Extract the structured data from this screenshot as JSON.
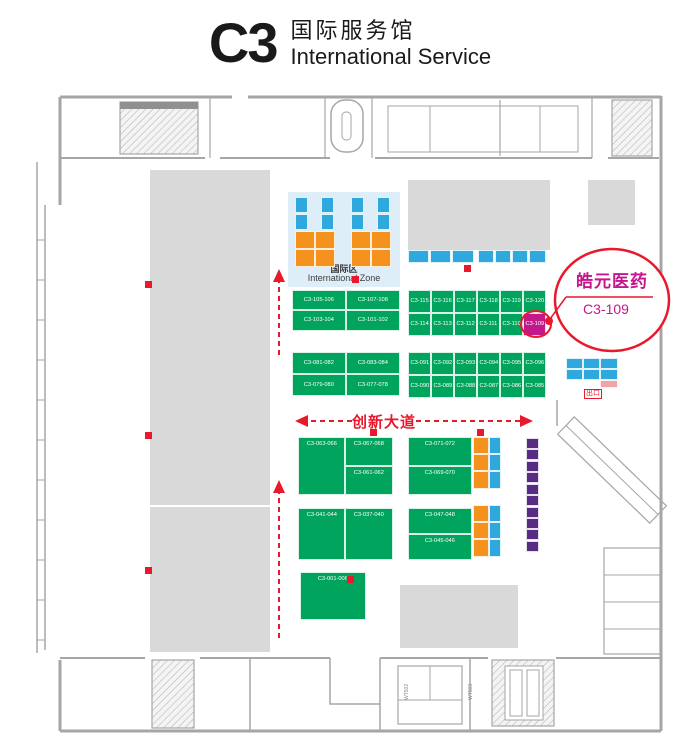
{
  "header": {
    "hall_code": "C3",
    "title_cn": "国际服务馆",
    "title_en": "International  Service"
  },
  "colors": {
    "green": "#00a45c",
    "blue": "#2fa8dd",
    "orange": "#f5921e",
    "purple": "#582c83",
    "magenta": "#c3188c",
    "pink": "#f0a3a8",
    "red": "#e8192c"
  },
  "international_zone": {
    "label_cn": "国际区",
    "label_en": "International Zone"
  },
  "road": {
    "label": "创新大道"
  },
  "callout": {
    "company": "皓元医药",
    "booth": "C3-109"
  },
  "exit": {
    "label": "出口"
  },
  "highlight_booth": "C3-109",
  "bottom_labels": [
    {
      "text": "WT502",
      "x": 404,
      "y": 700
    },
    {
      "text": "WT503",
      "x": 468,
      "y": 700
    }
  ],
  "markers": [
    {
      "x": 145,
      "y": 281
    },
    {
      "x": 145,
      "y": 432
    },
    {
      "x": 145,
      "y": 567
    },
    {
      "x": 464,
      "y": 265
    },
    {
      "x": 370,
      "y": 429
    },
    {
      "x": 477,
      "y": 429
    },
    {
      "x": 347,
      "y": 576
    }
  ],
  "blocks": [
    {
      "id": "intl-group-1",
      "x": 295,
      "y": 197,
      "color": "blue",
      "cells": [
        {
          "x": 0,
          "y": 0,
          "w": 13,
          "h": 16,
          "label": ""
        },
        {
          "x": 0,
          "y": 17,
          "w": 13,
          "h": 16,
          "label": ""
        },
        {
          "x": 26,
          "y": 0,
          "w": 13,
          "h": 16,
          "label": ""
        },
        {
          "x": 26,
          "y": 17,
          "w": 13,
          "h": 16,
          "label": ""
        },
        {
          "x": 0,
          "y": 34,
          "w": 20,
          "h": 18,
          "label": "",
          "color": "orange"
        },
        {
          "x": 20,
          "y": 34,
          "w": 20,
          "h": 18,
          "label": "",
          "color": "orange"
        },
        {
          "x": 0,
          "y": 52,
          "w": 20,
          "h": 18,
          "label": "",
          "color": "orange"
        },
        {
          "x": 20,
          "y": 52,
          "w": 20,
          "h": 18,
          "label": "",
          "color": "orange"
        }
      ]
    },
    {
      "id": "intl-group-2",
      "x": 351,
      "y": 197,
      "color": "blue",
      "cells": [
        {
          "x": 0,
          "y": 0,
          "w": 13,
          "h": 16,
          "label": ""
        },
        {
          "x": 0,
          "y": 17,
          "w": 13,
          "h": 16,
          "label": ""
        },
        {
          "x": 26,
          "y": 0,
          "w": 13,
          "h": 16,
          "label": ""
        },
        {
          "x": 26,
          "y": 17,
          "w": 13,
          "h": 16,
          "label": ""
        },
        {
          "x": 0,
          "y": 34,
          "w": 20,
          "h": 18,
          "label": "",
          "color": "orange"
        },
        {
          "x": 20,
          "y": 34,
          "w": 20,
          "h": 18,
          "label": "",
          "color": "orange"
        },
        {
          "x": 0,
          "y": 52,
          "w": 20,
          "h": 18,
          "label": "",
          "color": "orange"
        },
        {
          "x": 20,
          "y": 52,
          "w": 20,
          "h": 18,
          "label": "",
          "color": "orange"
        }
      ]
    },
    {
      "id": "service-row-left",
      "x": 408,
      "y": 250,
      "color": "blue",
      "cells": [
        {
          "x": 0,
          "y": 0,
          "w": 21,
          "h": 13,
          "label": ""
        },
        {
          "x": 22,
          "y": 0,
          "w": 21,
          "h": 13,
          "label": ""
        },
        {
          "x": 44,
          "y": 0,
          "w": 22,
          "h": 13,
          "label": ""
        }
      ]
    },
    {
      "id": "service-row-right",
      "x": 478,
      "y": 250,
      "color": "blue",
      "cells": [
        {
          "x": 0,
          "y": 0,
          "w": 16,
          "h": 13,
          "label": ""
        },
        {
          "x": 17,
          "y": 0,
          "w": 16,
          "h": 13,
          "label": ""
        },
        {
          "x": 34,
          "y": 0,
          "w": 16,
          "h": 13,
          "label": ""
        },
        {
          "x": 51,
          "y": 0,
          "w": 17,
          "h": 13,
          "label": ""
        }
      ]
    },
    {
      "id": "block-101-108",
      "x": 292,
      "y": 290,
      "color": "green",
      "cells": [
        {
          "x": 0,
          "y": 0,
          "w": 54,
          "h": 20,
          "label": "C3-105-106"
        },
        {
          "x": 54,
          "y": 0,
          "w": 54,
          "h": 20,
          "label": "C3-107-108"
        },
        {
          "x": 0,
          "y": 20,
          "w": 54,
          "h": 21,
          "label": "C3-103-104"
        },
        {
          "x": 54,
          "y": 20,
          "w": 54,
          "h": 21,
          "label": "C3-101-102"
        }
      ]
    },
    {
      "id": "block-109-120",
      "x": 408,
      "y": 290,
      "color": "green",
      "cells": [
        {
          "x": 0,
          "y": 0,
          "w": 23,
          "h": 23,
          "label": "C3-115"
        },
        {
          "x": 23,
          "y": 0,
          "w": 23,
          "h": 23,
          "label": "C3-116"
        },
        {
          "x": 46,
          "y": 0,
          "w": 23,
          "h": 23,
          "label": "C3-117"
        },
        {
          "x": 69,
          "y": 0,
          "w": 23,
          "h": 23,
          "label": "C3-118"
        },
        {
          "x": 92,
          "y": 0,
          "w": 23,
          "h": 23,
          "label": "C3-119"
        },
        {
          "x": 115,
          "y": 0,
          "w": 23,
          "h": 23,
          "label": "C3-120"
        },
        {
          "x": 0,
          "y": 23,
          "w": 23,
          "h": 23,
          "label": "C3-114"
        },
        {
          "x": 23,
          "y": 23,
          "w": 23,
          "h": 23,
          "label": "C3-113"
        },
        {
          "x": 46,
          "y": 23,
          "w": 23,
          "h": 23,
          "label": "C3-112"
        },
        {
          "x": 69,
          "y": 23,
          "w": 23,
          "h": 23,
          "label": "C3-111"
        },
        {
          "x": 92,
          "y": 23,
          "w": 23,
          "h": 23,
          "label": "C3-110"
        },
        {
          "x": 115,
          "y": 23,
          "w": 23,
          "h": 23,
          "label": "C3-109",
          "color": "magenta"
        }
      ]
    },
    {
      "id": "block-077-084",
      "x": 292,
      "y": 352,
      "color": "green",
      "cells": [
        {
          "x": 0,
          "y": 0,
          "w": 54,
          "h": 22,
          "label": "C3-081-082"
        },
        {
          "x": 54,
          "y": 0,
          "w": 54,
          "h": 22,
          "label": "C3-083-084"
        },
        {
          "x": 0,
          "y": 22,
          "w": 54,
          "h": 22,
          "label": "C3-079-080"
        },
        {
          "x": 54,
          "y": 22,
          "w": 54,
          "h": 22,
          "label": "C3-077-078"
        }
      ]
    },
    {
      "id": "block-085-096",
      "x": 408,
      "y": 352,
      "color": "green",
      "cells": [
        {
          "x": 0,
          "y": 0,
          "w": 23,
          "h": 23,
          "label": "C3-091"
        },
        {
          "x": 23,
          "y": 0,
          "w": 23,
          "h": 23,
          "label": "C3-092"
        },
        {
          "x": 46,
          "y": 0,
          "w": 23,
          "h": 23,
          "label": "C3-093"
        },
        {
          "x": 69,
          "y": 0,
          "w": 23,
          "h": 23,
          "label": "C3-094"
        },
        {
          "x": 92,
          "y": 0,
          "w": 23,
          "h": 23,
          "label": "C3-095"
        },
        {
          "x": 115,
          "y": 0,
          "w": 23,
          "h": 23,
          "label": "C3-096"
        },
        {
          "x": 0,
          "y": 23,
          "w": 23,
          "h": 23,
          "label": "C3-090"
        },
        {
          "x": 23,
          "y": 23,
          "w": 23,
          "h": 23,
          "label": "C3-089"
        },
        {
          "x": 46,
          "y": 23,
          "w": 23,
          "h": 23,
          "label": "C3-088"
        },
        {
          "x": 69,
          "y": 23,
          "w": 23,
          "h": 23,
          "label": "C3-087"
        },
        {
          "x": 92,
          "y": 23,
          "w": 23,
          "h": 23,
          "label": "C3-086"
        },
        {
          "x": 115,
          "y": 23,
          "w": 23,
          "h": 23,
          "label": "C3-085"
        }
      ]
    },
    {
      "id": "block-061-068",
      "x": 298,
      "y": 437,
      "color": "green",
      "cells": [
        {
          "x": 0,
          "y": 0,
          "w": 47,
          "h": 58,
          "label": "C3-063-066"
        },
        {
          "x": 47,
          "y": 0,
          "w": 48,
          "h": 29,
          "label": "C3-067-068"
        },
        {
          "x": 47,
          "y": 29,
          "w": 48,
          "h": 29,
          "label": "C3-061-062"
        }
      ]
    },
    {
      "id": "block-069-072",
      "x": 408,
      "y": 437,
      "color": "green",
      "cells": [
        {
          "x": 0,
          "y": 0,
          "w": 64,
          "h": 29,
          "label": "C3-071-072"
        },
        {
          "x": 0,
          "y": 29,
          "w": 64,
          "h": 29,
          "label": "C3-069-070"
        }
      ]
    },
    {
      "id": "block-037-044",
      "x": 298,
      "y": 508,
      "color": "green",
      "cells": [
        {
          "x": 0,
          "y": 0,
          "w": 47,
          "h": 52,
          "label": "C3-041-044"
        },
        {
          "x": 47,
          "y": 0,
          "w": 48,
          "h": 52,
          "label": "C3-037-040"
        }
      ]
    },
    {
      "id": "block-045-048",
      "x": 408,
      "y": 508,
      "color": "green",
      "cells": [
        {
          "x": 0,
          "y": 0,
          "w": 64,
          "h": 26,
          "label": "C3-047-048"
        },
        {
          "x": 0,
          "y": 26,
          "w": 64,
          "h": 26,
          "label": "C3-045-046"
        }
      ]
    },
    {
      "id": "block-001-006",
      "x": 300,
      "y": 572,
      "color": "green",
      "cells": [
        {
          "x": 0,
          "y": 0,
          "w": 66,
          "h": 48,
          "label": "C3-001-006"
        }
      ]
    },
    {
      "id": "small-booths-upper",
      "x": 473,
      "y": 437,
      "color": "orange",
      "cells": [
        {
          "x": 0,
          "y": 0,
          "w": 16,
          "h": 17,
          "label": ""
        },
        {
          "x": 0,
          "y": 17,
          "w": 16,
          "h": 17,
          "label": ""
        },
        {
          "x": 0,
          "y": 34,
          "w": 16,
          "h": 18,
          "label": ""
        },
        {
          "x": 16,
          "y": 0,
          "w": 12,
          "h": 17,
          "label": "",
          "color": "blue"
        },
        {
          "x": 16,
          "y": 17,
          "w": 12,
          "h": 17,
          "label": "",
          "color": "blue"
        },
        {
          "x": 16,
          "y": 34,
          "w": 12,
          "h": 18,
          "label": "",
          "color": "blue"
        }
      ]
    },
    {
      "id": "small-booths-lower",
      "x": 473,
      "y": 505,
      "color": "orange",
      "cells": [
        {
          "x": 0,
          "y": 0,
          "w": 16,
          "h": 17,
          "label": ""
        },
        {
          "x": 0,
          "y": 17,
          "w": 16,
          "h": 17,
          "label": ""
        },
        {
          "x": 0,
          "y": 34,
          "w": 16,
          "h": 18,
          "label": ""
        },
        {
          "x": 16,
          "y": 0,
          "w": 12,
          "h": 17,
          "label": "",
          "color": "blue"
        },
        {
          "x": 16,
          "y": 17,
          "w": 12,
          "h": 17,
          "label": "",
          "color": "blue"
        },
        {
          "x": 16,
          "y": 34,
          "w": 12,
          "h": 18,
          "label": "",
          "color": "blue"
        }
      ]
    },
    {
      "id": "purple-strip",
      "x": 526,
      "y": 438,
      "color": "purple",
      "cells": [
        {
          "x": 0,
          "y": 0,
          "w": 13,
          "h": 11,
          "label": ""
        },
        {
          "x": 0,
          "y": 11,
          "w": 13,
          "h": 11,
          "label": ""
        },
        {
          "x": 0,
          "y": 23,
          "w": 13,
          "h": 11,
          "label": ""
        },
        {
          "x": 0,
          "y": 34,
          "w": 13,
          "h": 11,
          "label": ""
        },
        {
          "x": 0,
          "y": 46,
          "w": 13,
          "h": 11,
          "label": ""
        },
        {
          "x": 0,
          "y": 57,
          "w": 13,
          "h": 11,
          "label": ""
        },
        {
          "x": 0,
          "y": 69,
          "w": 13,
          "h": 11,
          "label": ""
        },
        {
          "x": 0,
          "y": 80,
          "w": 13,
          "h": 11,
          "label": ""
        },
        {
          "x": 0,
          "y": 91,
          "w": 13,
          "h": 11,
          "label": ""
        },
        {
          "x": 0,
          "y": 103,
          "w": 13,
          "h": 11,
          "label": ""
        }
      ]
    },
    {
      "id": "exit-grid",
      "x": 566,
      "y": 358,
      "color": "blue",
      "cells": [
        {
          "x": 0,
          "y": 0,
          "w": 17,
          "h": 11,
          "label": ""
        },
        {
          "x": 17,
          "y": 0,
          "w": 17,
          "h": 11,
          "label": ""
        },
        {
          "x": 34,
          "y": 0,
          "w": 18,
          "h": 11,
          "label": ""
        },
        {
          "x": 0,
          "y": 11,
          "w": 17,
          "h": 11,
          "label": ""
        },
        {
          "x": 17,
          "y": 11,
          "w": 17,
          "h": 11,
          "label": ""
        },
        {
          "x": 34,
          "y": 11,
          "w": 18,
          "h": 11,
          "label": ""
        }
      ]
    },
    {
      "id": "exit-pink",
      "x": 600,
      "y": 380,
      "color": "pink",
      "cells": [
        {
          "x": 0,
          "y": 0,
          "w": 18,
          "h": 8,
          "label": ""
        }
      ]
    }
  ]
}
